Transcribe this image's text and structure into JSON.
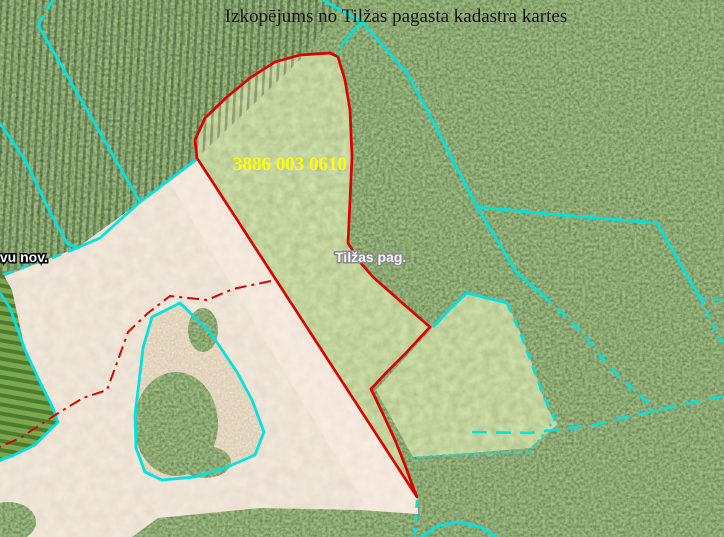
{
  "title": "Izkopējums no Tilžas pagasta kadastra kartes",
  "labels": {
    "parcel_number": {
      "text": "3886 003 0610"
    },
    "parish": {
      "text": "Tilžas pag."
    },
    "municipality": {
      "text": "lvu nov."
    }
  },
  "palette": {
    "boundary_red": "#db0000",
    "cadastral_cyan": "#00e2e2",
    "parcel_number_yellow": "#ffff00",
    "title_black": "#141414",
    "forest_green": "#2f4a1d",
    "field_green": "#84a45b",
    "sand_beige": "#d9c8b4",
    "road_beige": "#e6d4c2",
    "cleared_brown": "#c0a488"
  },
  "regions": [
    {
      "name": "sand-field",
      "points": [
        [
          0,
          278
        ],
        [
          77,
          248
        ],
        [
          140,
          202
        ],
        [
          197,
          160
        ],
        [
          417,
          497
        ],
        [
          420,
          537
        ],
        [
          0,
          537
        ]
      ],
      "fill": "#d9c8b4",
      "filter": "sandTex"
    },
    {
      "name": "road-strip",
      "points": [
        [
          197,
          160
        ],
        [
          417,
          497
        ],
        [
          420,
          537
        ],
        [
          385,
          537
        ],
        [
          168,
          180
        ]
      ],
      "fill": "#e6d4c2",
      "filter": "roadTex"
    },
    {
      "name": "striped-crop-field",
      "points": [
        [
          0,
          268
        ],
        [
          12,
          290
        ],
        [
          25,
          350
        ],
        [
          42,
          385
        ],
        [
          58,
          422
        ],
        [
          30,
          448
        ],
        [
          0,
          462
        ]
      ],
      "fill": "url(#cropRows)"
    },
    {
      "name": "main-parcel-field",
      "points": [
        [
          197,
          158
        ],
        [
          195,
          140
        ],
        [
          205,
          118
        ],
        [
          227,
          97
        ],
        [
          250,
          78
        ],
        [
          275,
          62
        ],
        [
          300,
          55
        ],
        [
          330,
          53
        ],
        [
          338,
          57
        ],
        [
          345,
          80
        ],
        [
          350,
          110
        ],
        [
          352,
          157
        ],
        [
          350,
          200
        ],
        [
          348,
          243
        ],
        [
          360,
          262
        ],
        [
          373,
          277
        ],
        [
          400,
          301
        ],
        [
          430,
          327
        ],
        [
          404,
          355
        ],
        [
          385,
          374
        ],
        [
          371,
          389
        ],
        [
          382,
          412
        ],
        [
          395,
          440
        ],
        [
          405,
          465
        ],
        [
          413,
          487
        ],
        [
          417,
          497
        ]
      ],
      "fill": "#84a45b",
      "filter": "fieldTex"
    },
    {
      "name": "second-parcel-field",
      "points": [
        [
          433,
          327
        ],
        [
          467,
          293
        ],
        [
          507,
          303
        ],
        [
          520,
          332
        ],
        [
          533,
          367
        ],
        [
          548,
          410
        ],
        [
          558,
          424
        ],
        [
          530,
          448
        ],
        [
          470,
          453
        ],
        [
          413,
          457
        ],
        [
          376,
          390
        ]
      ],
      "fill": "#84a45b",
      "filter": "fieldTex"
    },
    {
      "name": "cleared-island",
      "points": [
        [
          180,
          303
        ],
        [
          210,
          332
        ],
        [
          237,
          372
        ],
        [
          252,
          400
        ],
        [
          264,
          432
        ],
        [
          255,
          455
        ],
        [
          225,
          468
        ],
        [
          195,
          477
        ],
        [
          162,
          480
        ],
        [
          145,
          472
        ],
        [
          136,
          448
        ],
        [
          135,
          415
        ],
        [
          139,
          382
        ],
        [
          143,
          348
        ],
        [
          152,
          317
        ]
      ],
      "fill": "#c0a488",
      "filter": "islandTex"
    },
    {
      "name": "island-trees-large",
      "ellipse": [
        176,
        424,
        42,
        52
      ],
      "fill": "#2f4a1d",
      "filter": "forestTex"
    },
    {
      "name": "island-trees-south",
      "ellipse": [
        205,
        462,
        26,
        16
      ],
      "fill": "#2f4a1d",
      "filter": "forestTex"
    },
    {
      "name": "island-trees-north",
      "ellipse": [
        203,
        330,
        15,
        22
      ],
      "fill": "#2f4a1d",
      "filter": "forestTex"
    },
    {
      "name": "bottom-forest-band",
      "points": [
        [
          132,
          537
        ],
        [
          158,
          518
        ],
        [
          260,
          508
        ],
        [
          360,
          510
        ],
        [
          432,
          515
        ],
        [
          448,
          527
        ],
        [
          452,
          537
        ]
      ],
      "fill": "#2f4a1d",
      "filter": "forestTex"
    },
    {
      "name": "corner-tree",
      "ellipse": [
        8,
        522,
        28,
        20
      ],
      "fill": "#2f4a1d",
      "filter": "forestTex"
    },
    {
      "name": "plantation-rows-overlay",
      "points": [
        [
          0,
          0
        ],
        [
          345,
          0
        ],
        [
          300,
          60
        ],
        [
          197,
          158
        ],
        [
          140,
          202
        ],
        [
          77,
          248
        ],
        [
          0,
          275
        ]
      ],
      "fill": "url(#plantRows)",
      "opacity": 0.55
    }
  ],
  "lines": [
    {
      "name": "boundary-dash-topleft",
      "points": [
        [
          53,
          0
        ],
        [
          38,
          25
        ]
      ],
      "stroke": "#00e2e2",
      "width": 2.8,
      "dash": "11 7"
    },
    {
      "name": "topleft-diagonal-boundary",
      "points": [
        [
          38,
          25
        ],
        [
          140,
          202
        ]
      ],
      "stroke": "#00e2e2",
      "width": 2.8
    },
    {
      "name": "forest-edge-boundary",
      "points": [
        [
          197,
          159
        ],
        [
          140,
          202
        ],
        [
          100,
          238
        ],
        [
          77,
          248
        ]
      ],
      "stroke": "#00e2e2",
      "width": 2.8
    },
    {
      "name": "forest-edge-boundary-dashed",
      "points": [
        [
          77,
          248
        ],
        [
          52,
          258
        ],
        [
          30,
          265
        ],
        [
          0,
          276
        ]
      ],
      "stroke": "#00e2e2",
      "width": 2.6,
      "dash": "10 7"
    },
    {
      "name": "left-diagonal-boundary",
      "points": [
        [
          0,
          123
        ],
        [
          25,
          160
        ],
        [
          50,
          212
        ],
        [
          67,
          243
        ],
        [
          77,
          248
        ]
      ],
      "stroke": "#00e2e2",
      "width": 2.8
    },
    {
      "name": "striped-field-boundary",
      "points": [
        [
          0,
          293
        ],
        [
          10,
          308
        ],
        [
          25,
          350
        ],
        [
          40,
          382
        ],
        [
          53,
          408
        ],
        [
          58,
          422
        ],
        [
          35,
          445
        ],
        [
          12,
          456
        ],
        [
          0,
          460
        ]
      ],
      "stroke": "#00e2e2",
      "width": 2.8
    },
    {
      "name": "island-boundary",
      "closed": true,
      "points": [
        [
          180,
          303
        ],
        [
          210,
          332
        ],
        [
          237,
          372
        ],
        [
          252,
          400
        ],
        [
          264,
          432
        ],
        [
          255,
          455
        ],
        [
          225,
          468
        ],
        [
          195,
          477
        ],
        [
          162,
          480
        ],
        [
          145,
          472
        ],
        [
          136,
          448
        ],
        [
          135,
          415
        ],
        [
          139,
          382
        ],
        [
          143,
          348
        ],
        [
          152,
          317
        ]
      ],
      "stroke": "#00e2e2",
      "width": 2.8
    },
    {
      "name": "top-boundary-segment",
      "points": [
        [
          323,
          0
        ],
        [
          362,
          22
        ]
      ],
      "stroke": "#00e2e2",
      "width": 2.8
    },
    {
      "name": "top-vertex-drop",
      "points": [
        [
          362,
          22
        ],
        [
          343,
          43
        ]
      ],
      "stroke": "#00e2e2",
      "width": 2.8
    },
    {
      "name": "top-vertex-drop-dashed",
      "points": [
        [
          343,
          43
        ],
        [
          337,
          57
        ]
      ],
      "stroke": "#00e2e2",
      "width": 2.4,
      "dash": "5 5"
    },
    {
      "name": "long-diagonal-boundary",
      "points": [
        [
          362,
          22
        ],
        [
          407,
          73
        ],
        [
          427,
          110
        ],
        [
          477,
          207
        ],
        [
          517,
          273
        ],
        [
          543,
          295
        ]
      ],
      "stroke": "#00e2e2",
      "width": 2.8
    },
    {
      "name": "long-diagonal-dashed",
      "points": [
        [
          543,
          295
        ],
        [
          580,
          330
        ],
        [
          600,
          355
        ],
        [
          620,
          378
        ],
        [
          645,
          400
        ],
        [
          658,
          412
        ]
      ],
      "stroke": "#00e2e2",
      "width": 2.6,
      "dash": "12 8"
    },
    {
      "name": "east-branch-boundary",
      "points": [
        [
          477,
          207
        ],
        [
          560,
          215
        ],
        [
          657,
          223
        ],
        [
          700,
          298
        ]
      ],
      "stroke": "#00e2e2",
      "width": 2.8
    },
    {
      "name": "east-branch-dash-right",
      "points": [
        [
          700,
          298
        ],
        [
          723,
          300
        ]
      ],
      "stroke": "#00e2e2",
      "width": 2.4,
      "dash": "8 6"
    },
    {
      "name": "east-branch-dash-down",
      "points": [
        [
          700,
          298
        ],
        [
          724,
          347
        ]
      ],
      "stroke": "#00e2e2",
      "width": 2.4,
      "dash": "8 6"
    },
    {
      "name": "second-parcel-north-boundary",
      "points": [
        [
          433,
          327
        ],
        [
          450,
          309
        ],
        [
          467,
          293
        ],
        [
          507,
          303
        ]
      ],
      "stroke": "#00e2e2",
      "width": 2.8
    },
    {
      "name": "second-parcel-east-dashed",
      "points": [
        [
          507,
          303
        ],
        [
          519,
          330
        ],
        [
          531,
          362
        ],
        [
          543,
          395
        ],
        [
          555,
          420
        ]
      ],
      "stroke": "#00e2e2",
      "width": 2.6,
      "dash": "10 7"
    },
    {
      "name": "long-dashed-east-west",
      "points": [
        [
          472,
          432
        ],
        [
          530,
          433
        ],
        [
          570,
          428
        ],
        [
          600,
          424
        ],
        [
          627,
          417
        ],
        [
          680,
          405
        ],
        [
          724,
          396
        ]
      ],
      "stroke": "#00e2e2",
      "width": 2.6,
      "dash": "15 9"
    },
    {
      "name": "dotted-south-boundary",
      "points": [
        [
          410,
          458
        ],
        [
          450,
          455
        ],
        [
          490,
          453
        ],
        [
          530,
          452
        ]
      ],
      "stroke": "#00e2e2",
      "width": 2.4,
      "dash": "2.5 4"
    },
    {
      "name": "dotted-diagonal-boundary",
      "points": [
        [
          530,
          452
        ],
        [
          543,
          435
        ],
        [
          555,
          419
        ]
      ],
      "stroke": "#00e2e2",
      "width": 2.4,
      "dash": "2.5 4"
    },
    {
      "name": "south-dashed-vertical",
      "points": [
        [
          417,
          500
        ],
        [
          415,
          537
        ]
      ],
      "stroke": "#00e2e2",
      "width": 2.6,
      "dash": "8 6"
    },
    {
      "name": "bottom-arc-boundary",
      "points": [
        [
          421,
          537
        ],
        [
          438,
          526
        ],
        [
          458,
          522
        ],
        [
          480,
          527
        ],
        [
          497,
          537
        ]
      ],
      "stroke": "#00e2e2",
      "width": 2.8
    },
    {
      "name": "parcel-3886-boundary",
      "closed": true,
      "points": [
        [
          197,
          158
        ],
        [
          195,
          140
        ],
        [
          205,
          118
        ],
        [
          227,
          97
        ],
        [
          250,
          78
        ],
        [
          275,
          62
        ],
        [
          300,
          55
        ],
        [
          330,
          53
        ],
        [
          338,
          57
        ],
        [
          345,
          80
        ],
        [
          350,
          110
        ],
        [
          352,
          157
        ],
        [
          350,
          200
        ],
        [
          348,
          243
        ],
        [
          360,
          262
        ],
        [
          373,
          277
        ],
        [
          400,
          301
        ],
        [
          430,
          327
        ],
        [
          404,
          355
        ],
        [
          385,
          374
        ],
        [
          371,
          389
        ],
        [
          382,
          412
        ],
        [
          395,
          440
        ],
        [
          405,
          465
        ],
        [
          413,
          487
        ],
        [
          417,
          497
        ]
      ],
      "stroke": "#db0000",
      "width": 2.7
    },
    {
      "name": "red-cadastral-dashdot",
      "points": [
        [
          271,
          281
        ],
        [
          233,
          289
        ],
        [
          207,
          300
        ],
        [
          170,
          296
        ],
        [
          148,
          313
        ],
        [
          128,
          332
        ],
        [
          118,
          360
        ],
        [
          107,
          390
        ],
        [
          83,
          398
        ],
        [
          60,
          412
        ],
        [
          40,
          425
        ],
        [
          20,
          438
        ],
        [
          0,
          447
        ]
      ],
      "stroke": "#db0000",
      "width": 2,
      "dash": "12 5 3 5"
    }
  ]
}
